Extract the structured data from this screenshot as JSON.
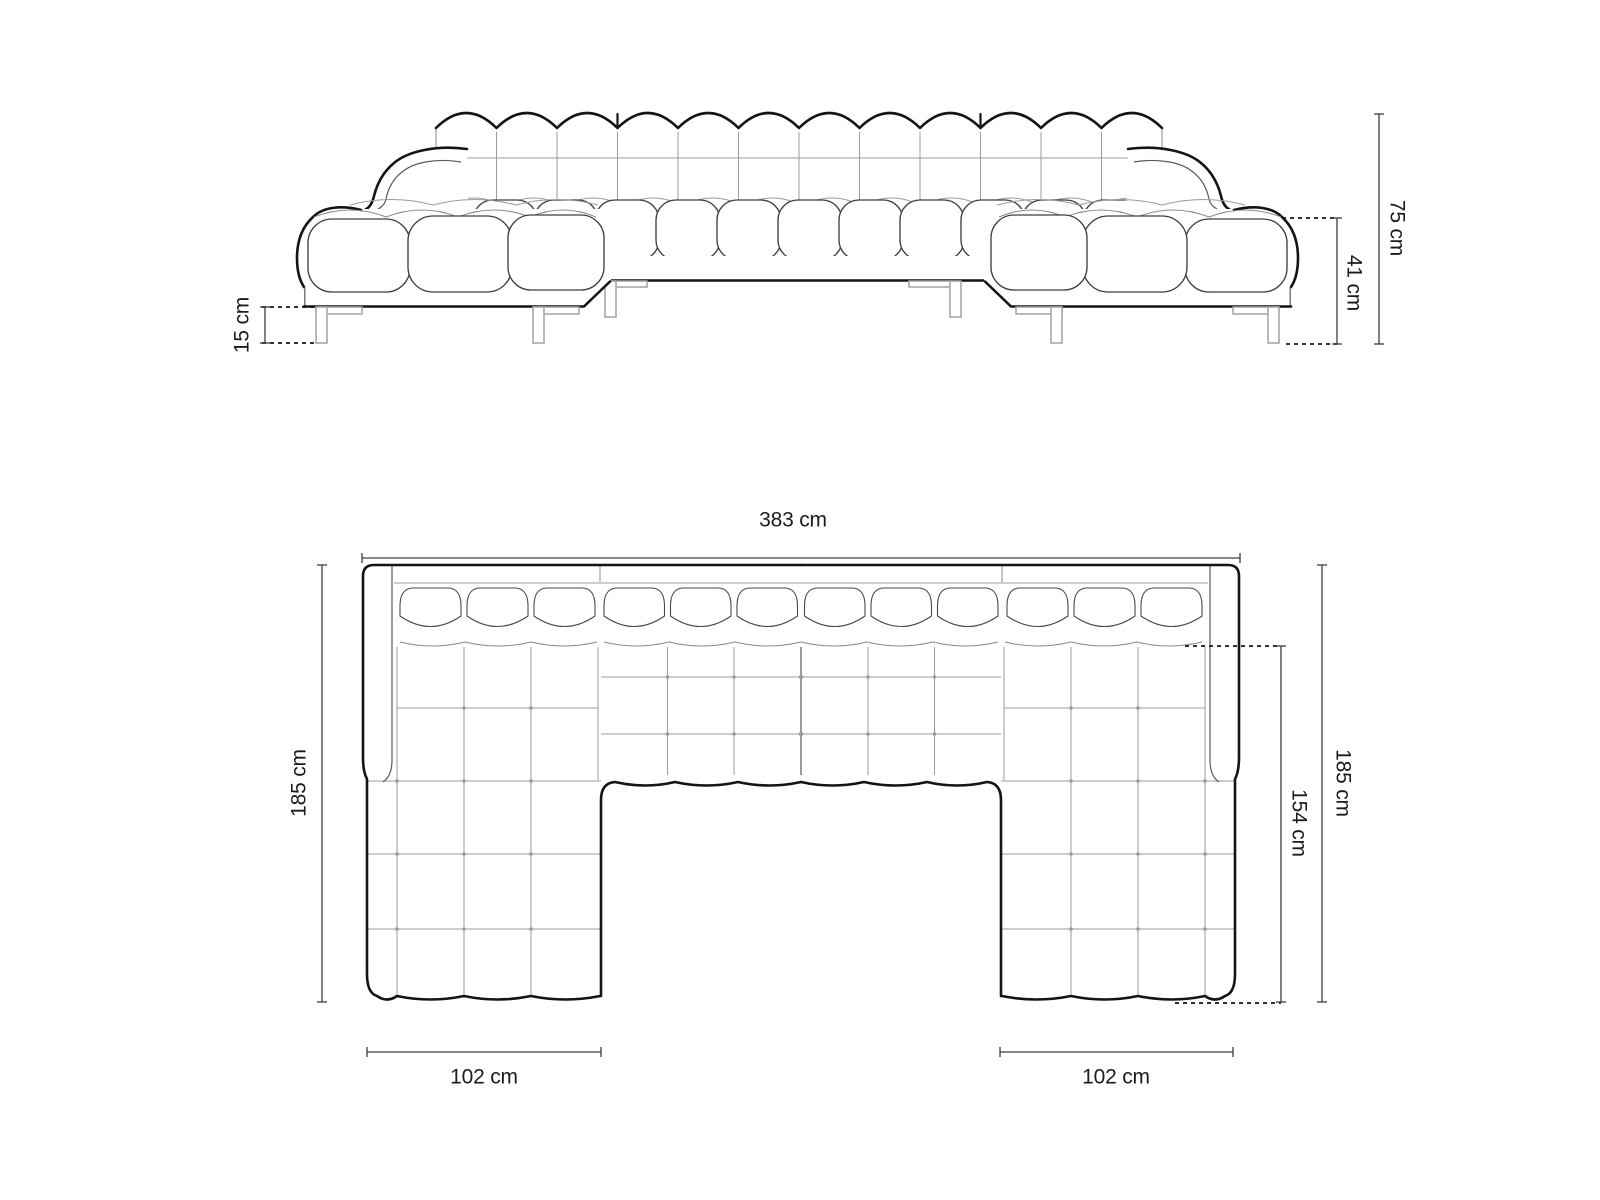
{
  "page": {
    "background": "#ffffff"
  },
  "diagram": {
    "type": "u-shaped-sofa-dimension-drawing",
    "views": {
      "front": {
        "name": "front-elevation",
        "labels": {
          "total_height": "75 cm",
          "arm_height": "41 cm",
          "leg_height": "15 cm"
        }
      },
      "top": {
        "name": "plan-view",
        "labels": {
          "total_width": "383 cm",
          "left_depth": "185 cm",
          "right_depth": "185 cm",
          "chaise_depth": "154 cm",
          "left_chaise_width": "102 cm",
          "right_chaise_width": "102 cm"
        }
      }
    },
    "colors": {
      "outline": "#141414",
      "seam": "#9b9b9b",
      "dimension_line": "#3d3d3d",
      "label_text": "#1b1b1b",
      "background": "#ffffff"
    }
  }
}
